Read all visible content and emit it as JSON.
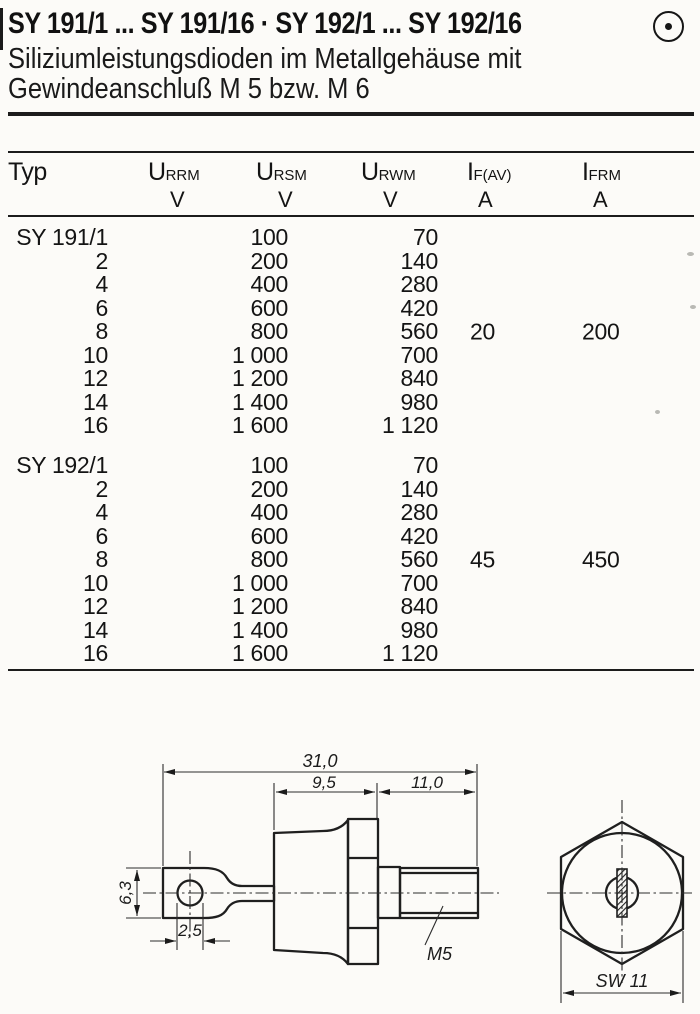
{
  "page": {
    "title": "SY 191/1 ... SY 191/16 · SY 192/1 ... SY 192/16",
    "subtitle_line1": "Siliziumleistungsdioden im Metallgehäuse mit",
    "subtitle_line2": "Gewindeanschluß M 5 bzw. M 6",
    "logo_icon": "circle-dot-icon"
  },
  "table": {
    "headers": [
      {
        "symbol": "Typ",
        "sub": "",
        "unit": ""
      },
      {
        "symbol": "U",
        "sub": "RRM",
        "unit": "V"
      },
      {
        "symbol": "U",
        "sub": "RSM",
        "unit": "V"
      },
      {
        "symbol": "U",
        "sub": "RWM",
        "unit": "V"
      },
      {
        "symbol": "I",
        "sub": "F(AV)",
        "unit": "A"
      },
      {
        "symbol": "I",
        "sub": "FRM",
        "unit": "A"
      }
    ],
    "blocks": [
      {
        "name": "SY 191",
        "if_av": "20",
        "ifrm": "200",
        "rows": [
          {
            "typ": "SY 191/1",
            "v1": "100",
            "v2": "70"
          },
          {
            "typ": "2",
            "v1": "200",
            "v2": "140"
          },
          {
            "typ": "4",
            "v1": "400",
            "v2": "280"
          },
          {
            "typ": "6",
            "v1": "600",
            "v2": "420"
          },
          {
            "typ": "8",
            "v1": "800",
            "v2": "560"
          },
          {
            "typ": "10",
            "v1": "1 000",
            "v2": "700"
          },
          {
            "typ": "12",
            "v1": "1 200",
            "v2": "840"
          },
          {
            "typ": "14",
            "v1": "1 400",
            "v2": "980"
          },
          {
            "typ": "16",
            "v1": "1 600",
            "v2": "1 120"
          }
        ]
      },
      {
        "name": "SY 192",
        "if_av": "45",
        "ifrm": "450",
        "rows": [
          {
            "typ": "SY 192/1",
            "v1": "100",
            "v2": "70"
          },
          {
            "typ": "2",
            "v1": "200",
            "v2": "140"
          },
          {
            "typ": "4",
            "v1": "400",
            "v2": "280"
          },
          {
            "typ": "6",
            "v1": "600",
            "v2": "420"
          },
          {
            "typ": "8",
            "v1": "800",
            "v2": "560"
          },
          {
            "typ": "10",
            "v1": "1 000",
            "v2": "700"
          },
          {
            "typ": "12",
            "v1": "1 200",
            "v2": "840"
          },
          {
            "typ": "14",
            "v1": "1 400",
            "v2": "980"
          },
          {
            "typ": "16",
            "v1": "1 600",
            "v2": "1 120"
          }
        ]
      }
    ]
  },
  "drawing": {
    "dim_total": "31,0",
    "dim_case": "9,5",
    "dim_thread": "11,0",
    "dim_tab_height": "6,3",
    "dim_hole": "2,5",
    "thread_label": "M5",
    "wrench_size": "SW 11"
  }
}
